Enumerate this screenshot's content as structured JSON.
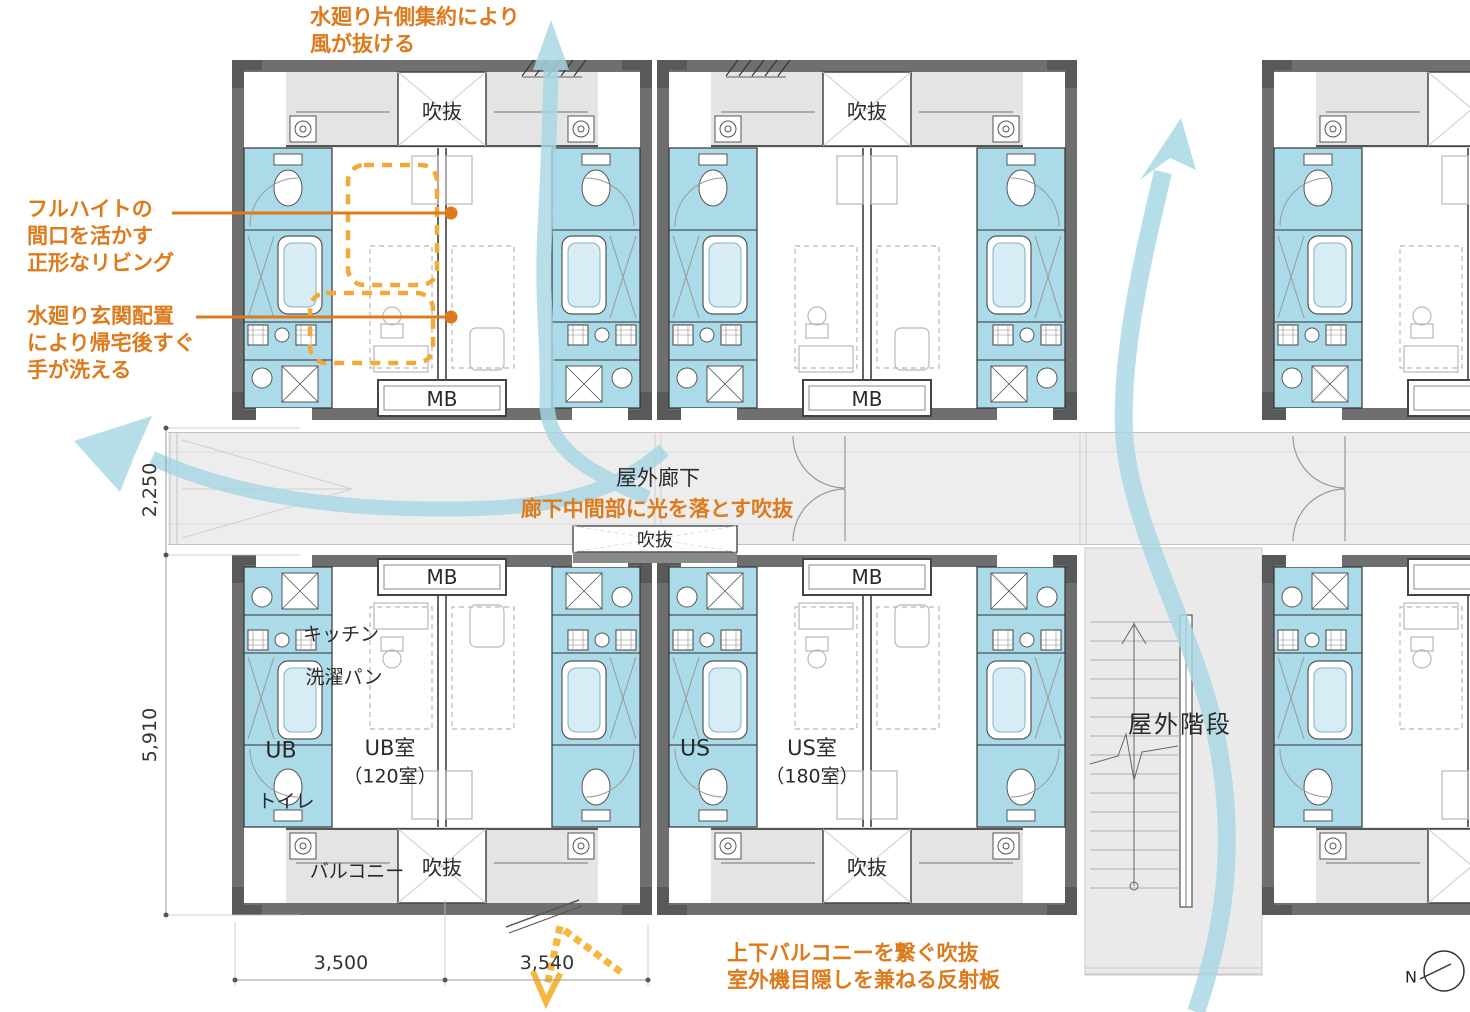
{
  "colors": {
    "accent_orange": "#DD7A1C",
    "highlight_dash_orange": "#F2A83A",
    "light_path_yellow": "#F6B63F",
    "airflow_blue": "#A7D7E4",
    "wet_area_blue": "#ABDAE9",
    "wall_gray": "#6F6F6F"
  },
  "annotations": {
    "airflow_top": {
      "line1": "水廻り片側集約により",
      "line2": "風が抜ける"
    },
    "living": {
      "line1": "フルハイトの",
      "line2": "間口を活かす",
      "line3": "正形なリビング"
    },
    "entrance_water": {
      "line1": "水廻り玄関配置",
      "line2": "により帰宅後すぐ",
      "line3": "手が洗える"
    },
    "corridor_void": {
      "text": "廊下中間部に光を落とす吹抜"
    },
    "balcony_void": {
      "line1": "上下バルコニーを繋ぐ吹抜",
      "line2": "室外機目隠しを兼ねる反射板"
    }
  },
  "labels": {
    "void": "吹抜",
    "meter_box": "MB",
    "outdoor_corridor": "屋外廊下",
    "outdoor_stairs": "屋外階段",
    "kitchen": "キッチン",
    "laundry_pan": "洗濯パン",
    "unit_bath": "UB",
    "ub_room": "UB室",
    "ub_room_count": "（120室）",
    "toilet": "トイレ",
    "balcony": "バルコニー",
    "unit_shower": "US",
    "us_room": "US室",
    "us_room_count": "（180室）",
    "north": "N"
  },
  "dimensions": {
    "corridor_depth": "2,250",
    "unit_depth": "5,910",
    "bay_width_left": "3,500",
    "bay_width_right": "3,540"
  }
}
